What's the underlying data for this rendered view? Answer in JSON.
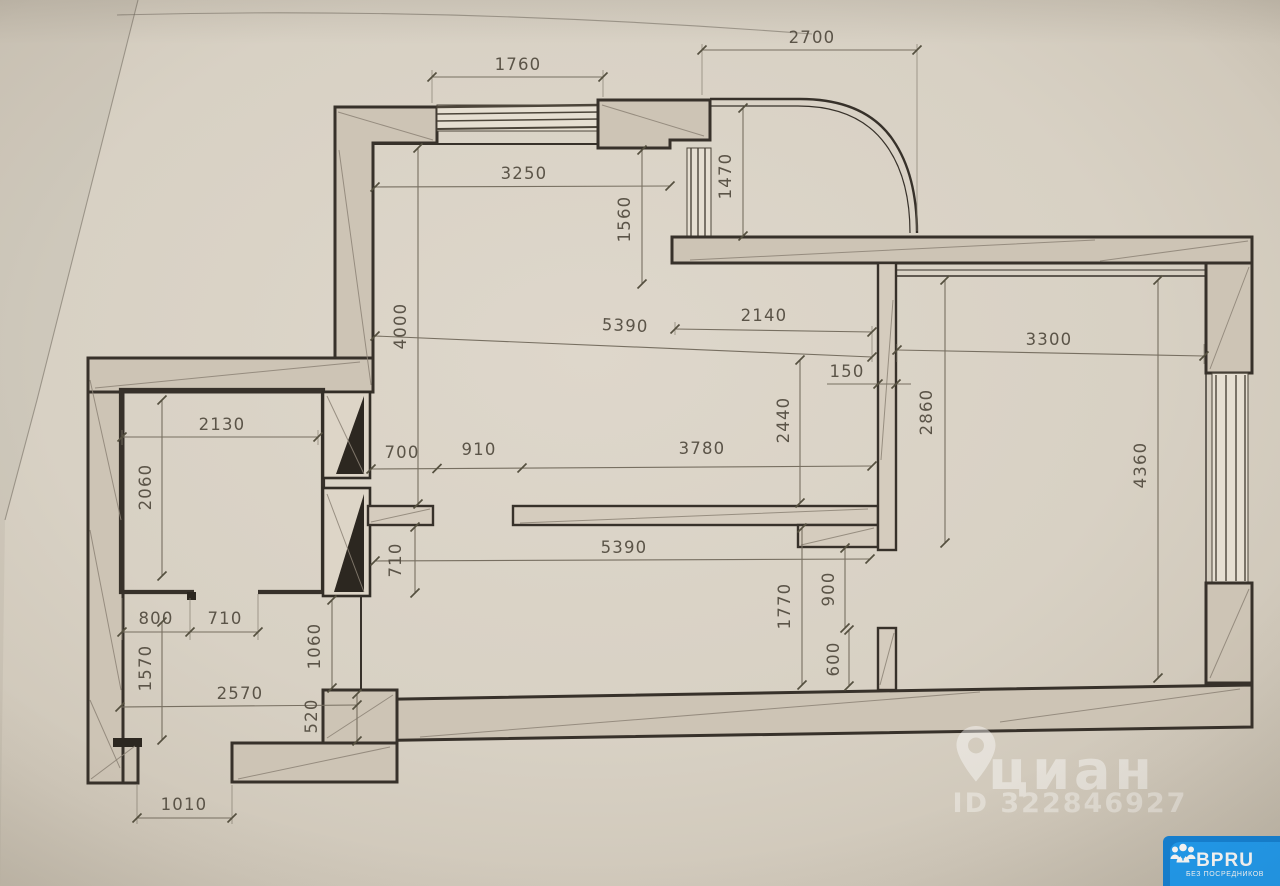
{
  "plan": {
    "dims": {
      "window_top": "1760",
      "balcony_width": "2700",
      "living_top_width": "3250",
      "alcove_depth": "1560",
      "balcony_depth": "1470",
      "living_height": "4000",
      "alcove_width": "2140",
      "living_full_width_top": "5390",
      "partition_thickness": "150",
      "bedroom_width": "3300",
      "kitchen_width": "2130",
      "kitchen_height": "2060",
      "opening_height": "2440",
      "bedroom_left_height": "2860",
      "wall_segment_left": "700",
      "doorway_width": "910",
      "wall_segment_right": "3780",
      "bedroom_right_height": "4360",
      "corridor_width": "710",
      "hall_full_width": "5390",
      "entry_nook_width": "800",
      "kitchen_door_width": "710",
      "shaft_offset": "1060",
      "hall_right_height": "1770",
      "bedroom_door_width": "900",
      "bedroom_door_jamb": "600",
      "entry_height": "1570",
      "entry_width": "2570",
      "step_depth": "520",
      "entry_door_width": "1010"
    }
  },
  "watermark": {
    "brand": "циан",
    "listing_id": "ID 322846927"
  },
  "badge": {
    "brand": "BPRU",
    "tagline": "БЕЗ ПОСРЕДНИКОВ"
  },
  "colors": {
    "paper": "#d8d1c4",
    "ink": "#39332b",
    "dim_lines": "#6f675a",
    "badge_blue": "#1f9df3",
    "watermark": "#ffffff"
  }
}
